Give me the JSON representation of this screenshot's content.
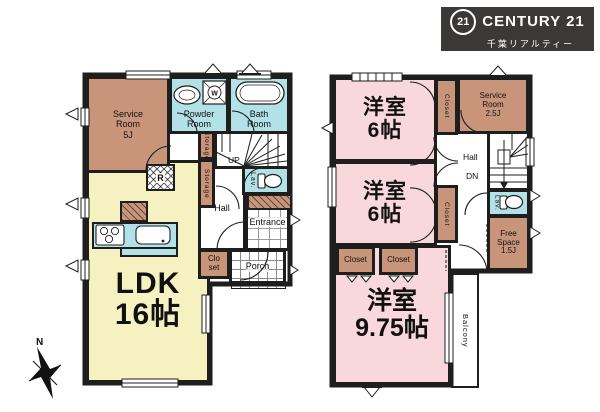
{
  "logo": {
    "badge": "21",
    "brand": "CENTURY 21",
    "sub": "千葉リアルティー"
  },
  "compass": {
    "north": "N"
  },
  "floor1": {
    "ldk": "LDK\n16帖",
    "service_room": "Service\nRoom\n5J",
    "powder_room": "Powder\nRoom",
    "bath_room": "Bath\nRoom",
    "stairs": "UP",
    "lav": "Lav.",
    "storage_upper": "Storage",
    "storage_lower": "Storage",
    "fridge": "R",
    "washer": "W",
    "hall": "Hall",
    "entrance": "Entrance",
    "closet": "Clo\nset",
    "porch": "Porch"
  },
  "floor2": {
    "bedroom1": "洋室\n6帖",
    "bedroom2": "洋室\n6帖",
    "bedroom3": "洋室\n9.75帖",
    "closet_right_top": "Closet",
    "closet_right_mid": "Closet",
    "closet_left": "Closet",
    "closet_center": "Closet",
    "service_room": "Service\nRoom\n2.5J",
    "hall": "Hall",
    "stairs": "DN",
    "lav": "Lav.",
    "free_space": "Free\nSpace\n1.5J",
    "balcony": "Balcony"
  },
  "colors": {
    "wall": "#1e1e1c",
    "room_pink": "#f8d8dc",
    "room_tan": "#c8947a",
    "room_yellow": "#f5f1c1",
    "wet_blue": "#b3e1e8",
    "logo_bg": "#3a3938"
  }
}
